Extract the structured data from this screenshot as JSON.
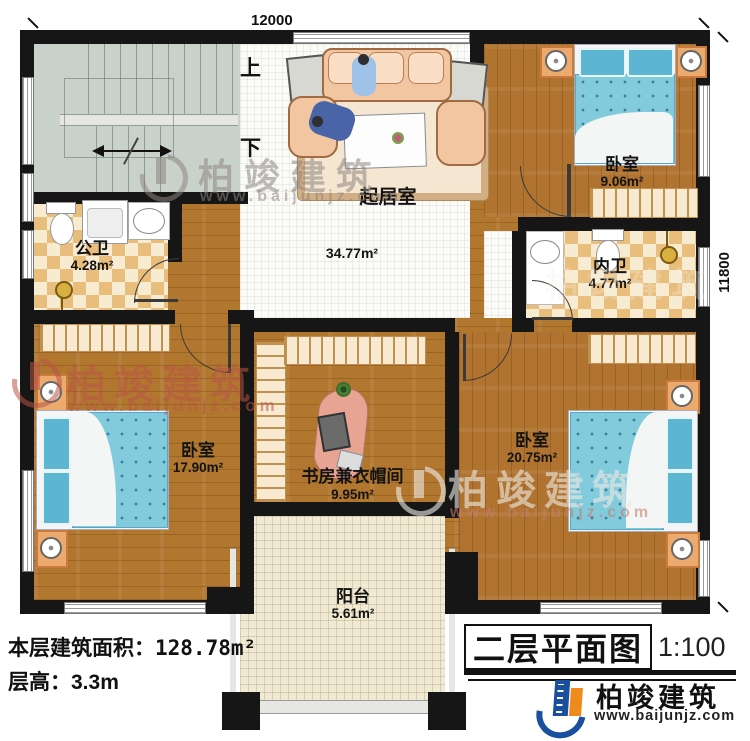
{
  "plan": {
    "dim_top": "12000",
    "dim_right": "11800",
    "stair_up": "上",
    "stair_down": "下"
  },
  "rooms": {
    "living": {
      "name": "起居室",
      "area": "34.77m²"
    },
    "bedroom_top_right": {
      "name": "卧室",
      "area": "9.06m²"
    },
    "public_bath": {
      "name": "公卫",
      "area": "4.28m²"
    },
    "private_bath": {
      "name": "内卫",
      "area": "4.77m²"
    },
    "bedroom_bottom_left": {
      "name": "卧室",
      "area": "17.90m²"
    },
    "study": {
      "name": "书房兼衣帽间",
      "area": "9.95m²"
    },
    "bedroom_bottom_right": {
      "name": "卧室",
      "area": "20.75m²"
    },
    "balcony": {
      "name": "阳台",
      "area": "5.61m²"
    }
  },
  "footer": {
    "area_label": "本层建筑面积：",
    "area_value": "128.78m²",
    "floor_height": "层高：3.3m"
  },
  "title_block": {
    "drawing_title": "二层平面图",
    "scale": "1:100"
  },
  "brand": {
    "name": "柏竣建筑",
    "url": "www.baijunjz.com"
  },
  "watermark": {
    "name": "柏竣建筑",
    "url": "www.baijunjz.com"
  },
  "colors": {
    "wall": "#161616",
    "wood": "#b2772f",
    "tile_tan": "#e9be7c",
    "mattress_blue": "#82cbdd",
    "brand_blue": "#1a4f9e",
    "brand_orange": "#ef8a1c"
  }
}
